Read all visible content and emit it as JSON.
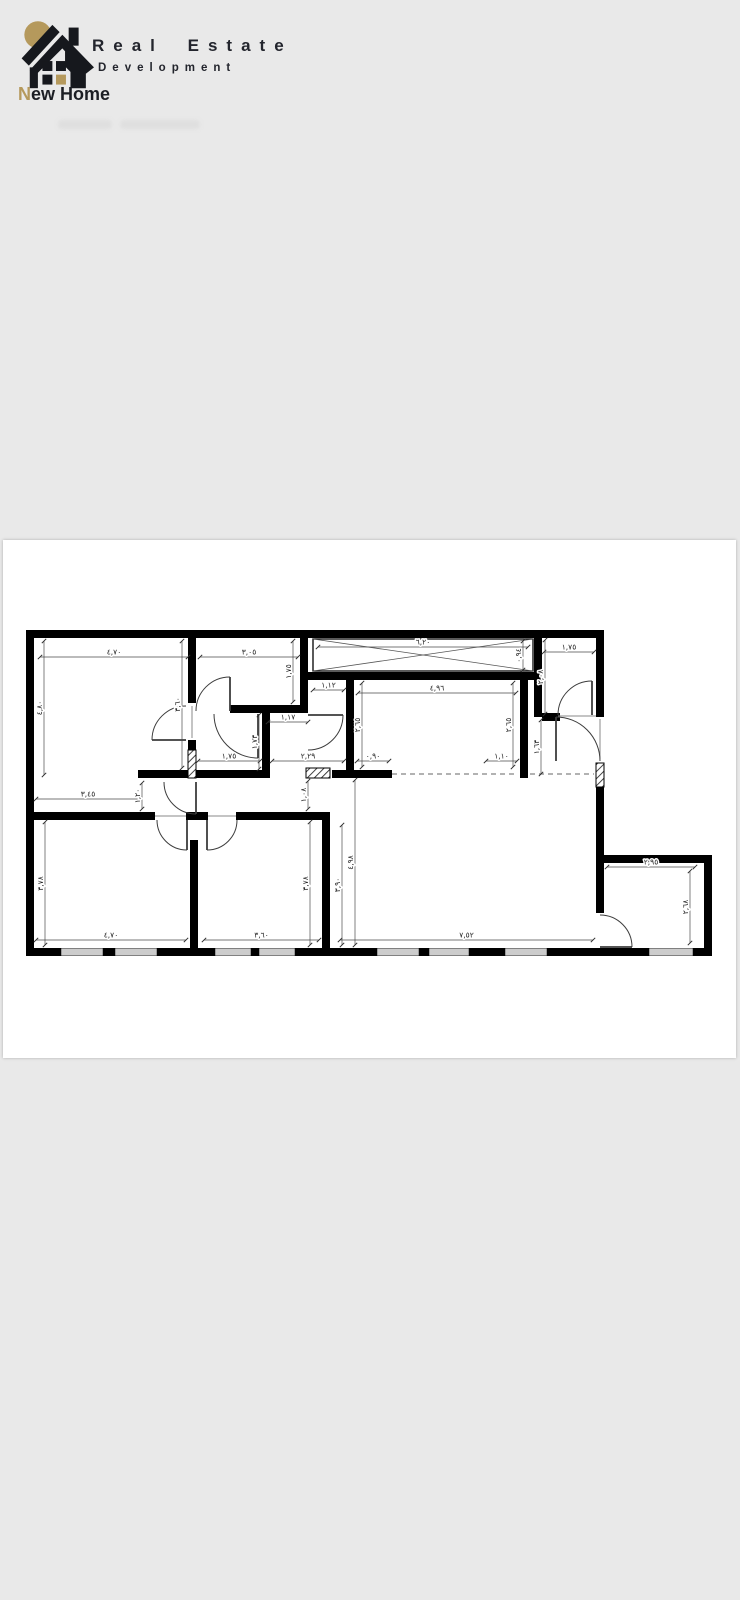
{
  "page": {
    "background": "#e9e9e9",
    "card_background": "#ffffff"
  },
  "logo": {
    "title": "Real Estate",
    "subtitle": "Development",
    "brand_initial": "N",
    "brand_rest": "ew Home",
    "accent_color": "#b5995c",
    "text_color": "#23252d"
  },
  "floorplan": {
    "wall_color": "#000000",
    "dimension_color": "#1e1e1e",
    "dimensions": [
      {
        "v": "٤,٧٠",
        "x1": 40,
        "y1": 117,
        "x2": 188,
        "y2": 117
      },
      {
        "v": "٣,٠٥",
        "x1": 200,
        "y1": 117,
        "x2": 298,
        "y2": 117
      },
      {
        "v": "٦,٢٠",
        "x1": 318,
        "y1": 107,
        "x2": 528,
        "y2": 107
      },
      {
        "v": "١,٧٥",
        "x1": 544,
        "y1": 112,
        "x2": 594,
        "y2": 112
      },
      {
        "v": "١,١٢",
        "x1": 313,
        "y1": 150,
        "x2": 344,
        "y2": 150
      },
      {
        "v": "٤,٩٦",
        "x1": 358,
        "y1": 153,
        "x2": 516,
        "y2": 153
      },
      {
        "v": "١,١٧",
        "x1": 268,
        "y1": 182,
        "x2": 308,
        "y2": 182
      },
      {
        "v": "١,٧٥",
        "x1": 198,
        "y1": 221,
        "x2": 260,
        "y2": 221
      },
      {
        "v": "٢,٢٩",
        "x1": 272,
        "y1": 221,
        "x2": 344,
        "y2": 221
      },
      {
        "v": "٠,٩٠",
        "x1": 357,
        "y1": 221,
        "x2": 389,
        "y2": 221
      },
      {
        "v": "١,١٠",
        "x1": 486,
        "y1": 221,
        "x2": 517,
        "y2": 221
      },
      {
        "v": "٣,٤٥",
        "x1": 36,
        "y1": 259,
        "x2": 140,
        "y2": 259
      },
      {
        "v": "٤,٧٠",
        "x1": 36,
        "y1": 400,
        "x2": 186,
        "y2": 400
      },
      {
        "v": "٣,٦٠",
        "x1": 204,
        "y1": 400,
        "x2": 319,
        "y2": 400
      },
      {
        "v": "٧,٥٢",
        "x1": 340,
        "y1": 400,
        "x2": 593,
        "y2": 400
      },
      {
        "v": "٢,٩٥",
        "x1": 607,
        "y1": 327,
        "x2": 695,
        "y2": 327
      },
      {
        "v": "٤,٨٠",
        "x1": 44,
        "y1": 101,
        "x2": 44,
        "y2": 235
      },
      {
        "v": "٣,٦٠",
        "x1": 182,
        "y1": 101,
        "x2": 182,
        "y2": 228
      },
      {
        "v": "١,٧٥",
        "x1": 293,
        "y1": 101,
        "x2": 293,
        "y2": 162
      },
      {
        "v": "٠,٩٤",
        "x1": 523,
        "y1": 101,
        "x2": 523,
        "y2": 130
      },
      {
        "v": "٢,٠٨",
        "x1": 545,
        "y1": 100,
        "x2": 545,
        "y2": 174
      },
      {
        "v": "٢,٦٥",
        "x1": 362,
        "y1": 143,
        "x2": 362,
        "y2": 227
      },
      {
        "v": "٢,٦٥",
        "x1": 513,
        "y1": 143,
        "x2": 513,
        "y2": 227
      },
      {
        "v": "١,٧٣",
        "x1": 259,
        "y1": 175,
        "x2": 259,
        "y2": 229
      },
      {
        "v": "١,٦٣",
        "x1": 541,
        "y1": 180,
        "x2": 541,
        "y2": 234
      },
      {
        "v": "١,٢٠",
        "x1": 142,
        "y1": 243,
        "x2": 142,
        "y2": 269
      },
      {
        "v": "١,٠٨",
        "x1": 308,
        "y1": 241,
        "x2": 308,
        "y2": 269
      },
      {
        "v": "٣,٧٨",
        "x1": 45,
        "y1": 282,
        "x2": 45,
        "y2": 405
      },
      {
        "v": "٣,٧٨",
        "x1": 310,
        "y1": 282,
        "x2": 310,
        "y2": 405
      },
      {
        "v": "٣,٩٠",
        "x1": 342,
        "y1": 285,
        "x2": 342,
        "y2": 405
      },
      {
        "v": "٤,٩٨",
        "x1": 355,
        "y1": 240,
        "x2": 355,
        "y2": 405
      },
      {
        "v": "٢,٦٨",
        "x1": 690,
        "y1": 331,
        "x2": 690,
        "y2": 403
      }
    ]
  }
}
